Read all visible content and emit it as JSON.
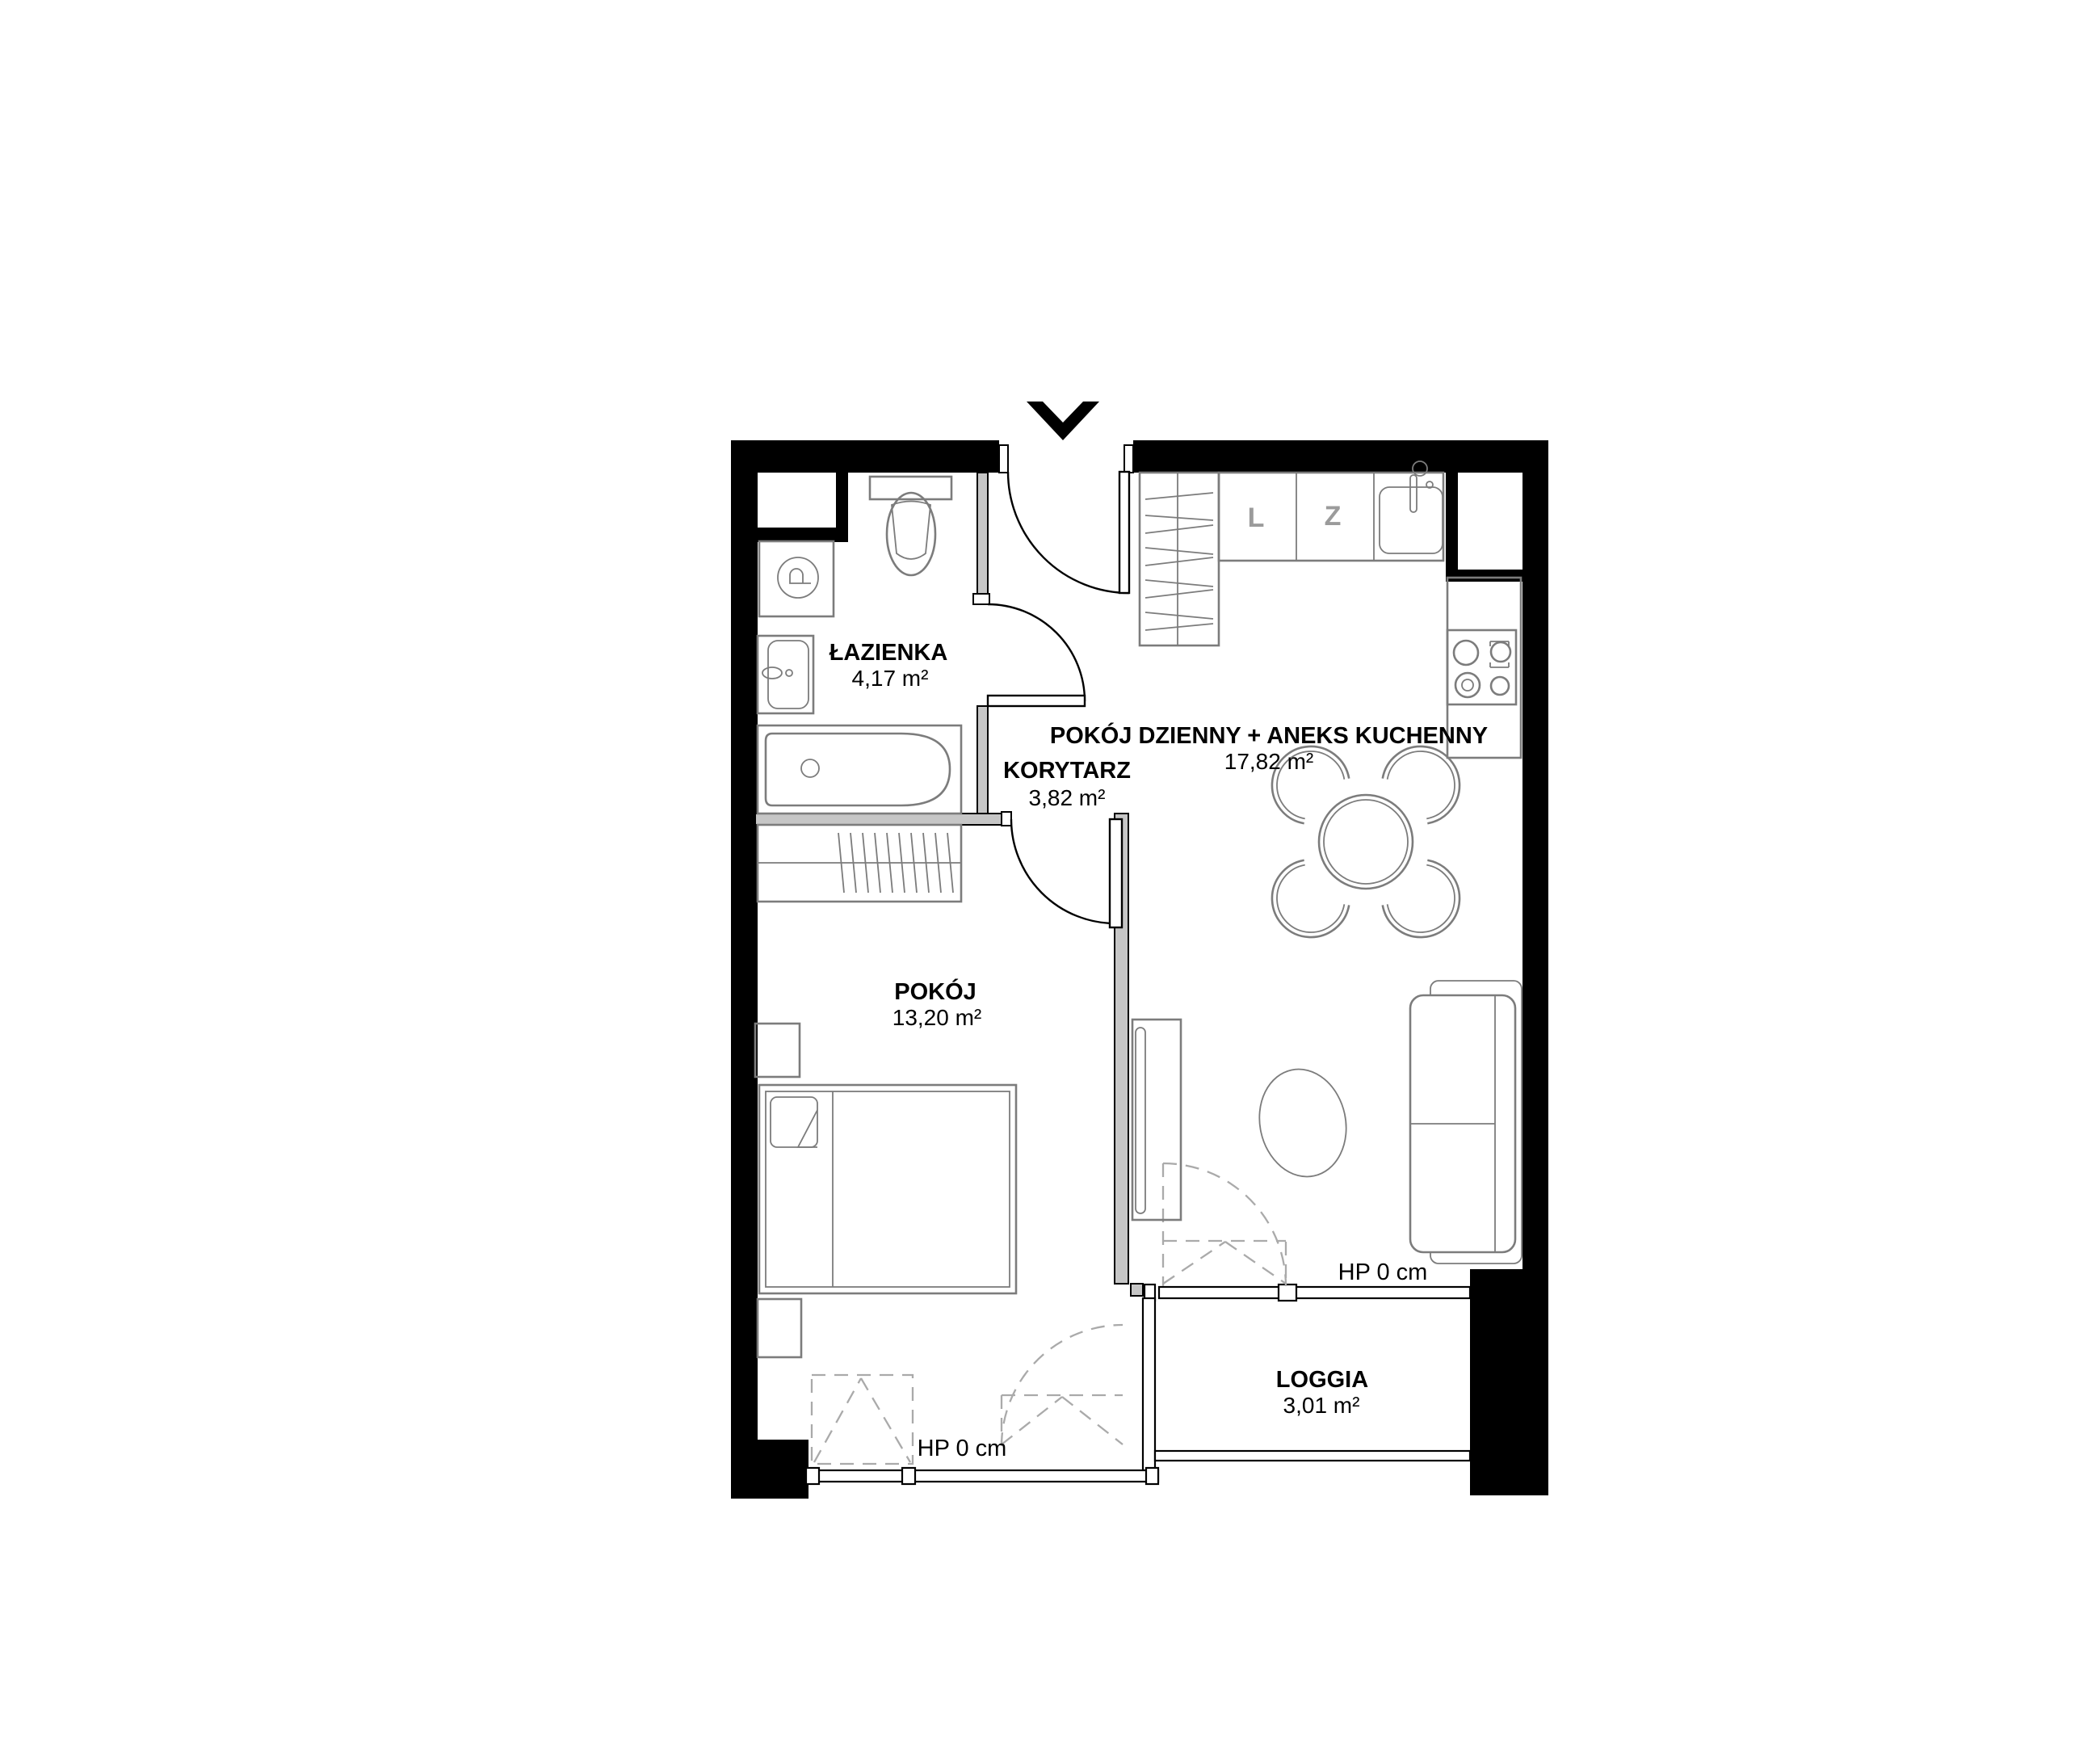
{
  "colors": {
    "wall": "#000000",
    "partition": "#c6c6c6",
    "furniture": "#7c7c7c",
    "dashed": "#aaaaaa",
    "marker": "#9b9b9b",
    "label": "#000000",
    "background": "#ffffff"
  },
  "rooms": {
    "bathroom": {
      "name": "ŁAZIENKA",
      "area": "4,17 m²"
    },
    "corridor": {
      "name": "KORYTARZ",
      "area": "3,82 m²"
    },
    "living": {
      "name": "POKÓJ DZIENNY + ANEKS KUCHENNY",
      "area": "17,82 m²"
    },
    "bedroom": {
      "name": "POKÓJ",
      "area": "13,20 m²"
    },
    "loggia": {
      "name": "LOGGIA",
      "area": "3,01 m²"
    }
  },
  "annotations": {
    "hp_living": "HP 0 cm",
    "hp_bedroom": "HP 0 cm"
  },
  "kitchen_markers": {
    "l": "L",
    "z": "Z"
  }
}
